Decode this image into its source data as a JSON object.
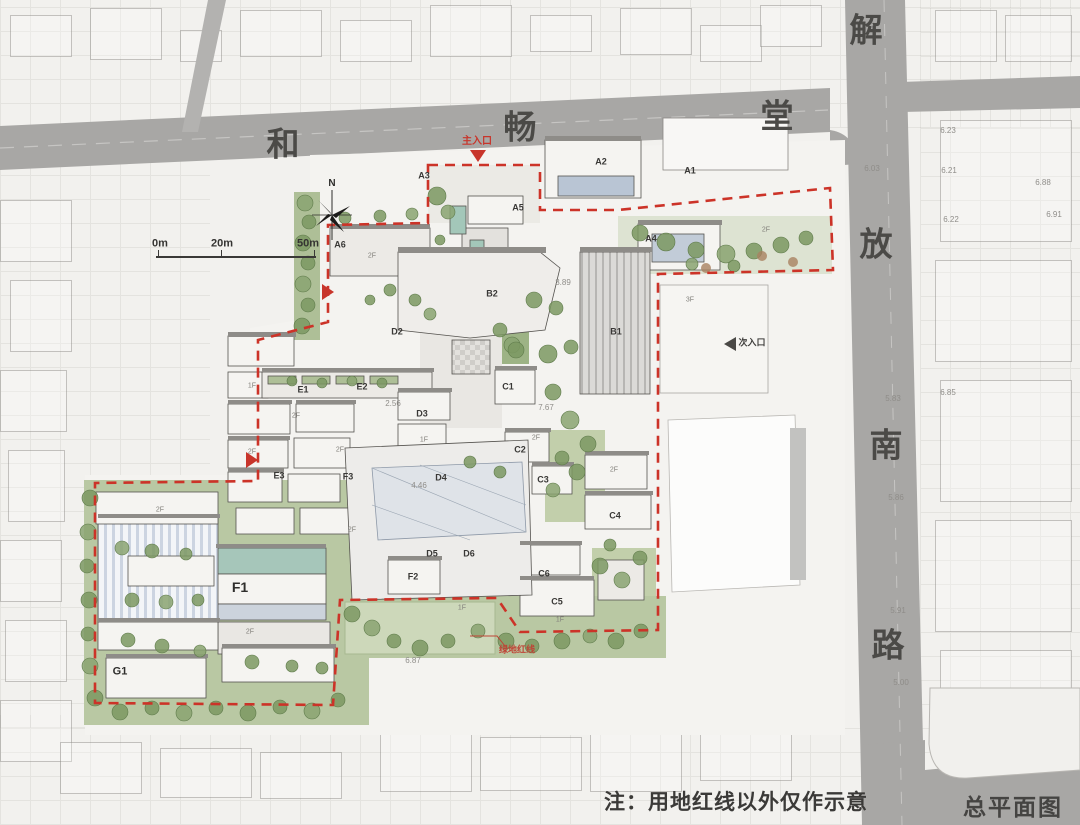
{
  "meta": {
    "drawing_title": "总平面图",
    "note": "注：用地红线以外仅作示意"
  },
  "streets": {
    "hechangtang": {
      "name": "和畅堂",
      "labels": [
        {
          "t": "和",
          "x": 283,
          "y": 144
        },
        {
          "t": "畅",
          "x": 520,
          "y": 127
        },
        {
          "t": "堂",
          "x": 777,
          "y": 116
        }
      ]
    },
    "jiefang_south_road": {
      "name": "解放南路",
      "labels": [
        {
          "t": "解",
          "x": 866,
          "y": 30
        },
        {
          "t": "放",
          "x": 876,
          "y": 244
        },
        {
          "t": "南",
          "x": 886,
          "y": 445
        },
        {
          "t": "路",
          "x": 888,
          "y": 645
        }
      ]
    }
  },
  "compass": {
    "label": "N"
  },
  "scale_bar": {
    "ticks": [
      {
        "t": "0m",
        "x": 160,
        "y": 244
      },
      {
        "t": "20m",
        "x": 222,
        "y": 244
      },
      {
        "t": "50m",
        "x": 308,
        "y": 244
      }
    ]
  },
  "entrances": {
    "main": {
      "t": "主入口",
      "x": 477,
      "y": 142
    },
    "secondary": {
      "t": "次入口",
      "x": 752,
      "y": 343
    }
  },
  "red_lines": {
    "green_line_label": {
      "t": "绿地红线",
      "x": 517,
      "y": 650
    }
  },
  "major_buildings": {
    "f1": "F1",
    "g1": "G1"
  },
  "buildings": [
    {
      "t": "A1",
      "x": 690,
      "y": 171
    },
    {
      "t": "A2",
      "x": 601,
      "y": 162
    },
    {
      "t": "A3",
      "x": 424,
      "y": 176
    },
    {
      "t": "A4",
      "x": 651,
      "y": 239
    },
    {
      "t": "A5",
      "x": 518,
      "y": 208
    },
    {
      "t": "A6",
      "x": 340,
      "y": 245
    },
    {
      "t": "B1",
      "x": 616,
      "y": 332
    },
    {
      "t": "B2",
      "x": 492,
      "y": 294
    },
    {
      "t": "C1",
      "x": 508,
      "y": 387
    },
    {
      "t": "C2",
      "x": 520,
      "y": 450
    },
    {
      "t": "C3",
      "x": 543,
      "y": 480
    },
    {
      "t": "C4",
      "x": 615,
      "y": 516
    },
    {
      "t": "C5",
      "x": 557,
      "y": 602
    },
    {
      "t": "C6",
      "x": 544,
      "y": 574
    },
    {
      "t": "D2",
      "x": 397,
      "y": 332
    },
    {
      "t": "D3",
      "x": 422,
      "y": 414
    },
    {
      "t": "D4",
      "x": 441,
      "y": 478
    },
    {
      "t": "D5",
      "x": 432,
      "y": 554
    },
    {
      "t": "D6",
      "x": 469,
      "y": 554
    },
    {
      "t": "E1",
      "x": 303,
      "y": 390
    },
    {
      "t": "E2",
      "x": 362,
      "y": 387
    },
    {
      "t": "E3",
      "x": 279,
      "y": 476
    },
    {
      "t": "F2",
      "x": 413,
      "y": 577
    },
    {
      "t": "F3",
      "x": 348,
      "y": 477
    }
  ],
  "floor_tags": [
    {
      "t": "2F",
      "x": 372,
      "y": 256
    },
    {
      "t": "2F",
      "x": 296,
      "y": 416
    },
    {
      "t": "2F",
      "x": 340,
      "y": 450
    },
    {
      "t": "1F",
      "x": 252,
      "y": 386
    },
    {
      "t": "2F",
      "x": 252,
      "y": 452
    },
    {
      "t": "2F",
      "x": 536,
      "y": 438
    },
    {
      "t": "2F",
      "x": 614,
      "y": 470
    },
    {
      "t": "1F",
      "x": 560,
      "y": 620
    },
    {
      "t": "2F",
      "x": 250,
      "y": 632
    },
    {
      "t": "1F",
      "x": 462,
      "y": 608
    },
    {
      "t": "2F",
      "x": 160,
      "y": 510
    },
    {
      "t": "3F",
      "x": 690,
      "y": 300
    },
    {
      "t": "2F",
      "x": 766,
      "y": 230
    },
    {
      "t": "2F",
      "x": 352,
      "y": 530
    },
    {
      "t": "1F",
      "x": 424,
      "y": 440
    }
  ],
  "elevations": [
    {
      "t": "5.83",
      "x": 893,
      "y": 399
    },
    {
      "t": "5.86",
      "x": 896,
      "y": 498
    },
    {
      "t": "5.91",
      "x": 898,
      "y": 611
    },
    {
      "t": "5.00",
      "x": 901,
      "y": 683
    },
    {
      "t": "6.03",
      "x": 872,
      "y": 169
    },
    {
      "t": "6.23",
      "x": 948,
      "y": 131
    },
    {
      "t": "6.21",
      "x": 949,
      "y": 171
    },
    {
      "t": "6.22",
      "x": 951,
      "y": 220
    },
    {
      "t": "6.88",
      "x": 1043,
      "y": 183
    },
    {
      "t": "6.91",
      "x": 1054,
      "y": 215
    },
    {
      "t": "6.85",
      "x": 948,
      "y": 393
    },
    {
      "t": "7.67",
      "x": 546,
      "y": 408
    },
    {
      "t": "4.46",
      "x": 419,
      "y": 486
    },
    {
      "t": "2.56",
      "x": 393,
      "y": 404
    },
    {
      "t": "3.89",
      "x": 563,
      "y": 283
    },
    {
      "t": "6.87",
      "x": 413,
      "y": 661
    }
  ],
  "colors": {
    "red_line": "#cc3328",
    "road": "#a8a7a5",
    "tree": "#7b9862",
    "water": "#a3c7b9"
  }
}
